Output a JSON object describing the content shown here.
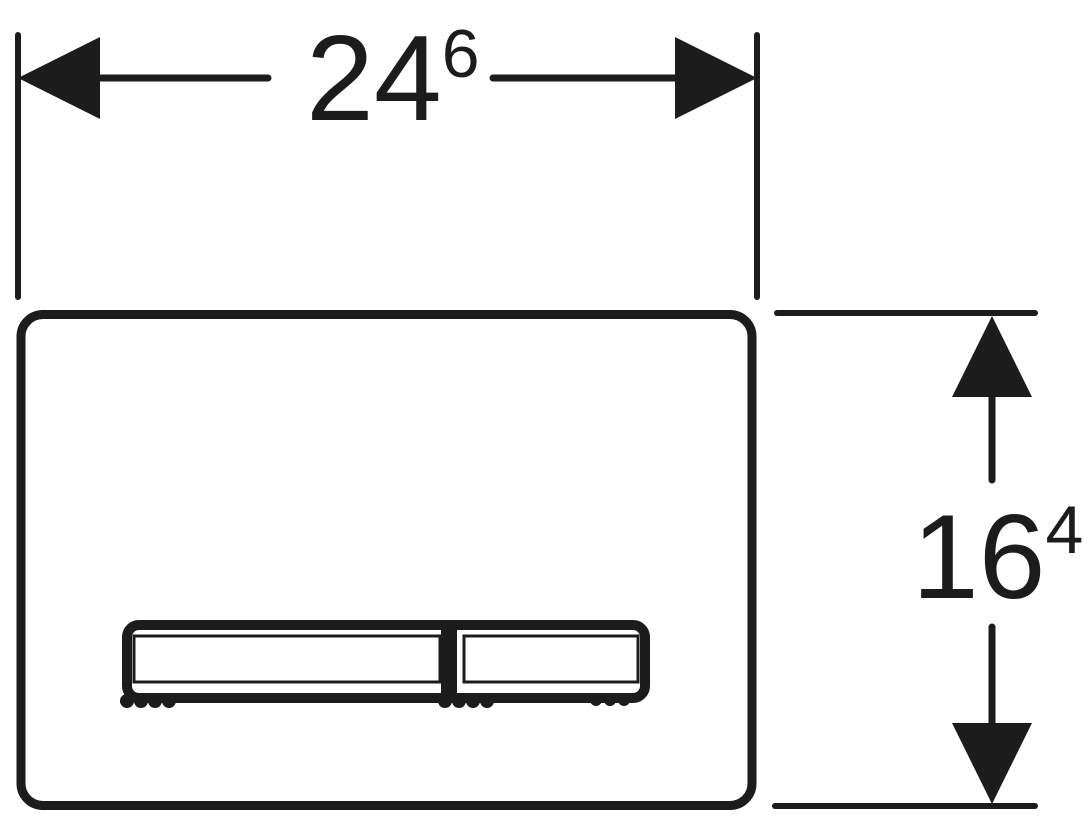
{
  "colors": {
    "ink": "#1c1c1c",
    "background": "#ffffff"
  },
  "dimensions": {
    "width": {
      "main": "24",
      "sup": "6"
    },
    "height": {
      "main": "16",
      "sup": "4"
    }
  },
  "icons": {
    "width_dimension_arrows": [
      "arrow-left-icon",
      "arrow-right-icon"
    ],
    "height_dimension_arrows": [
      "arrow-up-icon",
      "arrow-down-icon"
    ]
  }
}
